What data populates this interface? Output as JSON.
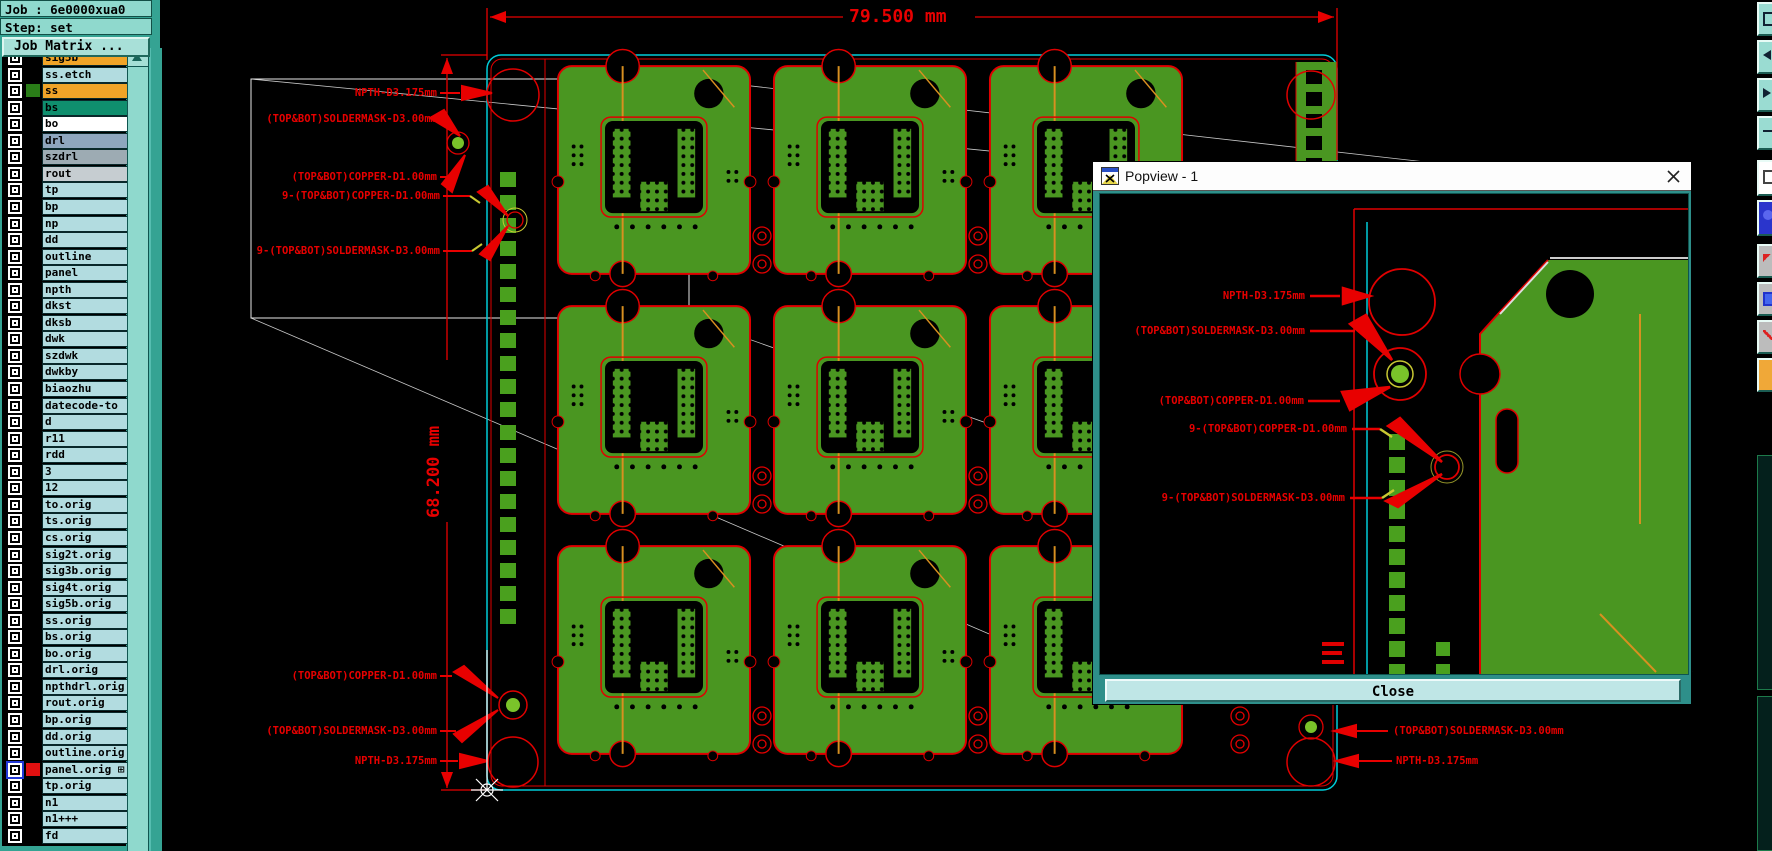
{
  "header": {
    "job_label": "Job : 6e0000xua0",
    "step_label": "Step: set",
    "job_matrix_label": "Job Matrix ..."
  },
  "sidebar": {
    "layers": [
      {
        "name": "sig5b",
        "bg": "#f0a428",
        "swatch": "#000000"
      },
      {
        "name": "ss.etch",
        "bg": "#b2dce0",
        "swatch": "#000000"
      },
      {
        "name": "ss",
        "bg": "#f0a428",
        "swatch": "#2a7d18"
      },
      {
        "name": "bs",
        "bg": "#0f8f6e",
        "swatch": "#000000"
      },
      {
        "name": "bo",
        "bg": "#ffffff",
        "swatch": "#000000"
      },
      {
        "name": "drl",
        "bg": "#8ea6be",
        "swatch": "#000000"
      },
      {
        "name": "szdrl",
        "bg": "#9dabb3",
        "swatch": "#000000"
      },
      {
        "name": "rout",
        "bg": "#c6cdd1",
        "swatch": "#000000"
      },
      {
        "name": "tp",
        "bg": "#b2dce0",
        "swatch": "#000000"
      },
      {
        "name": "bp",
        "bg": "#b2dce0",
        "swatch": "#000000"
      },
      {
        "name": "np",
        "bg": "#b2dce0",
        "swatch": "#000000"
      },
      {
        "name": "dd",
        "bg": "#b2dce0",
        "swatch": "#000000"
      },
      {
        "name": "outline",
        "bg": "#b2dce0",
        "swatch": "#000000"
      },
      {
        "name": "panel",
        "bg": "#b2dce0",
        "swatch": "#000000"
      },
      {
        "name": "npth",
        "bg": "#b2dce0",
        "swatch": "#000000"
      },
      {
        "name": "dkst",
        "bg": "#b2dce0",
        "swatch": "#000000"
      },
      {
        "name": "dksb",
        "bg": "#b2dce0",
        "swatch": "#000000"
      },
      {
        "name": "dwk",
        "bg": "#b2dce0",
        "swatch": "#000000"
      },
      {
        "name": "szdwk",
        "bg": "#b2dce0",
        "swatch": "#000000"
      },
      {
        "name": "dwkby",
        "bg": "#b2dce0",
        "swatch": "#000000"
      },
      {
        "name": "biaozhu",
        "bg": "#b2dce0",
        "swatch": "#000000"
      },
      {
        "name": "datecode-to",
        "bg": "#b2dce0",
        "swatch": "#000000"
      },
      {
        "name": "d",
        "bg": "#b2dce0",
        "swatch": "#000000"
      },
      {
        "name": "r11",
        "bg": "#b2dce0",
        "swatch": "#000000"
      },
      {
        "name": "rdd",
        "bg": "#b2dce0",
        "swatch": "#000000"
      },
      {
        "name": "3",
        "bg": "#b2dce0",
        "swatch": "#000000"
      },
      {
        "name": "12",
        "bg": "#b2dce0",
        "swatch": "#000000"
      },
      {
        "name": "to.orig",
        "bg": "#b2dce0",
        "swatch": "#000000"
      },
      {
        "name": "ts.orig",
        "bg": "#b2dce0",
        "swatch": "#000000"
      },
      {
        "name": "cs.orig",
        "bg": "#b2dce0",
        "swatch": "#000000"
      },
      {
        "name": "sig2t.orig",
        "bg": "#b2dce0",
        "swatch": "#000000"
      },
      {
        "name": "sig3b.orig",
        "bg": "#b2dce0",
        "swatch": "#000000"
      },
      {
        "name": "sig4t.orig",
        "bg": "#b2dce0",
        "swatch": "#000000"
      },
      {
        "name": "sig5b.orig",
        "bg": "#b2dce0",
        "swatch": "#000000"
      },
      {
        "name": "ss.orig",
        "bg": "#b2dce0",
        "swatch": "#000000"
      },
      {
        "name": "bs.orig",
        "bg": "#b2dce0",
        "swatch": "#000000"
      },
      {
        "name": "bo.orig",
        "bg": "#b2dce0",
        "swatch": "#000000"
      },
      {
        "name": "drl.orig",
        "bg": "#b2dce0",
        "swatch": "#000000"
      },
      {
        "name": "npthdrl.orig",
        "bg": "#b2dce0",
        "swatch": "#000000"
      },
      {
        "name": "rout.orig",
        "bg": "#b2dce0",
        "swatch": "#000000"
      },
      {
        "name": "bp.orig",
        "bg": "#b2dce0",
        "swatch": "#000000"
      },
      {
        "name": "dd.orig",
        "bg": "#b2dce0",
        "swatch": "#000000"
      },
      {
        "name": "outline.orig",
        "bg": "#b2dce0",
        "swatch": "#000000"
      },
      {
        "name": "panel.orig",
        "bg": "#b2dce0",
        "swatch": "#e01010",
        "selected": true,
        "flag": true
      },
      {
        "name": "tp.orig",
        "bg": "#b2dce0",
        "swatch": "#000000"
      },
      {
        "name": "n1",
        "bg": "#b2dce0",
        "swatch": "#000000"
      },
      {
        "name": "n1+++",
        "bg": "#b2dce0",
        "swatch": "#000000"
      },
      {
        "name": "fd",
        "bg": "#b2dce0",
        "swatch": "#000000"
      }
    ]
  },
  "dims": {
    "width_label": "79.500 mm",
    "height_label": "68.200 mm"
  },
  "annotations": {
    "npth": "NPTH-D3.175mm",
    "soldermask": "(TOP&BOT)SOLDERMASK-D3.00mm",
    "copper": "(TOP&BOT)COPPER-D1.00mm",
    "copper9": "9-(TOP&BOT)COPPER-D1.00mm",
    "soldermask9": "9-(TOP&BOT)SOLDERMASK-D3.00mm"
  },
  "popup": {
    "title": "Popview - 1",
    "close_label": "Close"
  },
  "colors": {
    "board_green": "#4a9621",
    "bright_green": "#4aa01e",
    "annotation_red": "#e80000",
    "panel_cyan": "#00ccd8",
    "orange_line": "#d89020",
    "sidebar_teal": "#35a393",
    "header_teal": "#8fd9cd",
    "selected_layer_swatch": "#e01010"
  }
}
